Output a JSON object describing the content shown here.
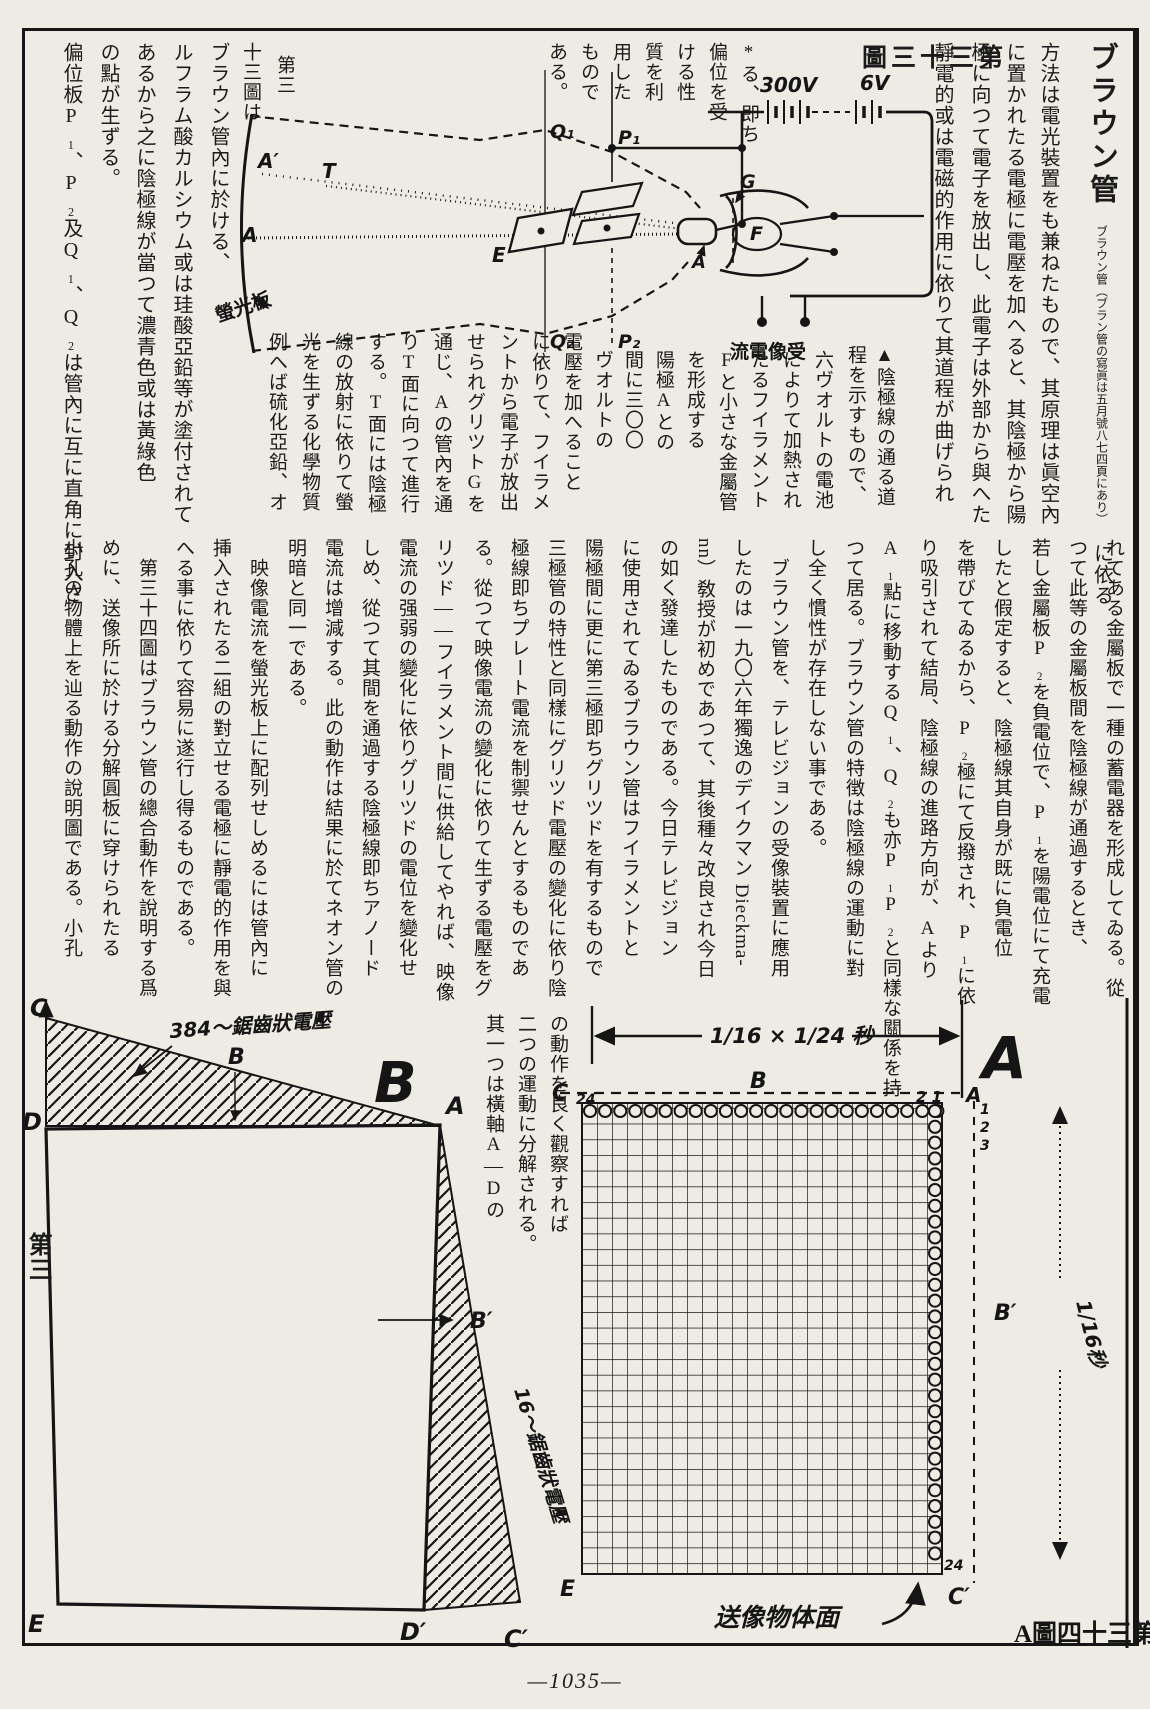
{
  "page": {
    "number": "—1035—",
    "margin_label": "第三"
  },
  "title_col": {
    "title": "ブラウン管",
    "body": "ブラウン管（ブラン管の寫眞は五月號八七四頁にあり）",
    "tail": "に依る"
  },
  "upper_right": [
    "方法は電光裝置をも兼ねたもので、其原理は眞空內",
    "に置かれたる電極に電壓を加へると、其陰極から陽",
    "極に向つて電子を放出し、此電子は外部から與へた",
    "靜電的或は電磁的作用に依りて其道程が曲げられ"
  ],
  "upper_top": [
    "*る、即ち",
    "偏位を受",
    "ける性",
    "質を利",
    "用した",
    "もので",
    "ある。",
    "第三",
    "十三圖は"
  ],
  "upper_mid": [
    "▲陰極線の通る道",
    "程を示すもので、",
    "六ヴオルトの電池",
    "によりて加熱され",
    "たるフイラメント",
    "Fと小さな金屬管",
    "を形成する",
    "陽極Aとの",
    "間に三〇〇",
    "ヴオルトの",
    "電壓を加へること",
    "に依りて、フイラメ",
    "ントから電子が放出",
    "せられグリツトGを",
    "通じ、Aの管內を通",
    "りT面に向つて進行",
    "する。T面には陰極",
    "線の放射に依りて螢",
    "光を生ずる化學物質",
    "例へば硫化亞鉛、オ"
  ],
  "upper_left": [
    "ブラウン管內に於ける、",
    "ルフラム酸カルシウム或は珪酸亞鉛等が塗付されて",
    "あるから之に陰極線が當つて濃青色或は黃綠色",
    "の點が生ずる。",
    "偏位板P₁、P₂及Q₁、Q₂は管內に互に直角に封入さ"
  ],
  "lower": [
    "れてある金屬板で一種の蓄電器を形成してゐる。從",
    "つて此等の金屬板間を陰極線が通過するとき、",
    "若し金屬板P₂を負電位で、P₁を陽電位にて充電",
    "したと假定すると、陰極線其自身が既に負電位",
    "を帶びてゐるから、P₂極にて反撥され、P₁に依",
    "り吸引されて結局、陰極線の進路方向が、Aより",
    "A₁點に移動するQ₁、Q₂も亦P₁P₂と同樣な關係を持",
    "つて居る。ブラウン管の特徴は陰極線の運動に對",
    "し全く慣性が存在しない事である。",
    "　ブラウン管を、テレビジョンの受像裝置に應用",
    "したのは一九〇六年獨逸のデイクマン Dieckma-",
    "nn）敎授が初めであつて、其後種々改良され今日",
    "の如く發達したものである。今日テレビジョン",
    "に使用されてゐるブラウン管はフイラメントと",
    "陽極間に更に第三極即ちグリツドを有するもので",
    "三極管の特性と同樣にグリツド電壓の變化に依り陰",
    "極線即ちプレート電流を制禦せんとするものであ",
    "る。從つて映像電流の變化に依りて生ずる電壓をグ",
    "リツド——フイラメント間に供給してやれば、映像",
    "電流の强弱の變化に依りグリツドの電位を變化せ",
    "しめ、從つて其間を通過する陰極線即ちアノード",
    "電流は增減する。此の動作は結果に於てネオン管の",
    "明暗と同一である。",
    "　映像電流を螢光板上に配列せしめるには管內に",
    "挿入されたる二組の對立せる電極に靜電的作用を與",
    "へる事に依りて容易に遂行し得るものである。",
    "　第三十四圖はブラウン管の總合動作を說明する爲",
    "めに、送像所に於ける分解圓板に穿けられたる",
    "小孔の物體上を辿る動作の說明圖である。小孔"
  ],
  "between": [
    "の動作を良く觀察すれば",
    "二つの運動に分解される。",
    "其一つは橫軸A—Dの"
  ],
  "fig33": {
    "caption": "圖三十三第",
    "labels": {
      "aprime": "A′",
      "t": "T",
      "a": "A",
      "e": "E",
      "q1": "Q₁",
      "q2": "Q₂",
      "p1": "P₁",
      "p2": "P₂",
      "g": "G",
      "f": "F",
      "anode": "A",
      "v300": "300V",
      "v6": "6V",
      "screen": "螢光板",
      "current": "流電像受"
    }
  },
  "figsaw": {
    "saw384": "384〜鋸齒狀電壓",
    "saw16": "16〜鋸齒狀電壓",
    "c": "C",
    "b": "B",
    "bigb": "B",
    "d": "D",
    "a": "A",
    "bprime": "B′",
    "e": "E",
    "dprime": "D′",
    "cprime": "C′"
  },
  "fig34": {
    "caption": "A圖四十三第",
    "time": "1/16 × 1/24 秒",
    "biga": "A",
    "c": "C",
    "n24": "24",
    "b": "B",
    "n21": "2 1",
    "a": "A",
    "r1": "1",
    "r2": "2",
    "r3": "3",
    "bprime": "B′",
    "sec": "1/16秒",
    "surface": "送像物体面",
    "e": "E",
    "cprime": "C′",
    "n24b": "24"
  }
}
